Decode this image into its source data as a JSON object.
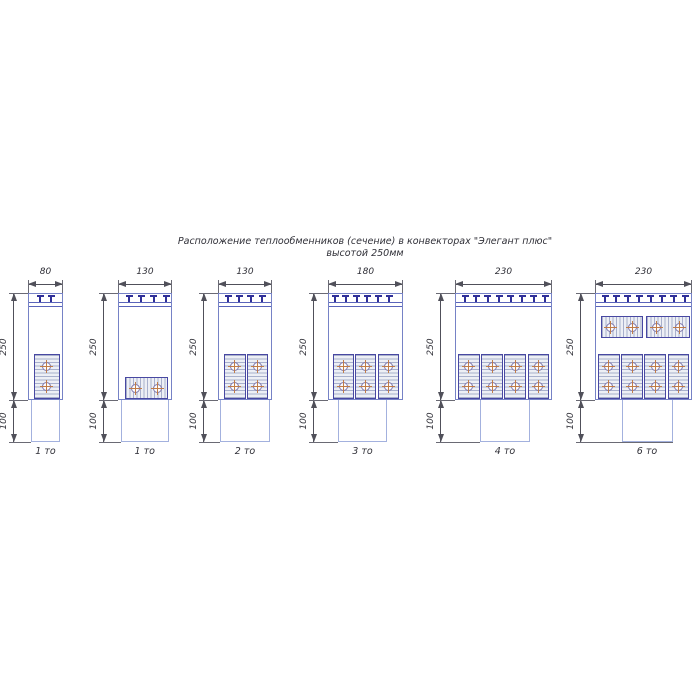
{
  "title": {
    "line1": "Расположение теплообменников (сечение) в конвекторах \"Элегант плюс\"",
    "line2": "высотой 250мм"
  },
  "dim_labels": {
    "height": "250",
    "duct_height": "100"
  },
  "diagrams": [
    {
      "width_label": "80",
      "caption": "1 то",
      "teeth": 2,
      "blocks": [
        {
          "orient": "v"
        }
      ]
    },
    {
      "width_label": "130",
      "caption": "1 то",
      "teeth": 4,
      "blocks": [
        {
          "orient": "h"
        }
      ]
    },
    {
      "width_label": "130",
      "caption": "2 то",
      "teeth": 4,
      "blocks": [
        {
          "orient": "v"
        },
        {
          "orient": "v"
        }
      ]
    },
    {
      "width_label": "180",
      "caption": "3 то",
      "teeth": 6,
      "blocks": [
        {
          "orient": "v"
        },
        {
          "orient": "v"
        },
        {
          "orient": "v"
        }
      ]
    },
    {
      "width_label": "230",
      "caption": "4 то",
      "teeth": 8,
      "blocks": [
        {
          "orient": "v"
        },
        {
          "orient": "v"
        },
        {
          "orient": "v"
        },
        {
          "orient": "v"
        }
      ]
    },
    {
      "width_label": "230",
      "caption": "6 то",
      "teeth": 8,
      "blocks": [
        {
          "orient": "h"
        },
        {
          "orient": "h"
        },
        {
          "orient": "v"
        },
        {
          "orient": "v"
        },
        {
          "orient": "v"
        },
        {
          "orient": "v"
        }
      ]
    }
  ]
}
